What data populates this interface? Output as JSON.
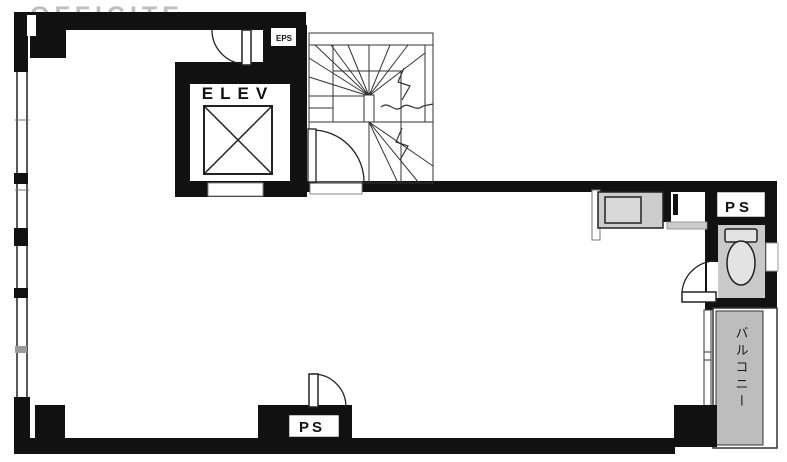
{
  "watermark": "OFFICITE",
  "labels": {
    "elevator": "ELEV",
    "eps": "EPS",
    "pipe_space_right": "PS",
    "pipe_space_bottom": "PS",
    "balcony": "バルコニー"
  },
  "colors": {
    "wall": "#111111",
    "fixture_fill": "#cccccc",
    "balcony_fill": "#bdbdbd",
    "background": "#ffffff"
  }
}
